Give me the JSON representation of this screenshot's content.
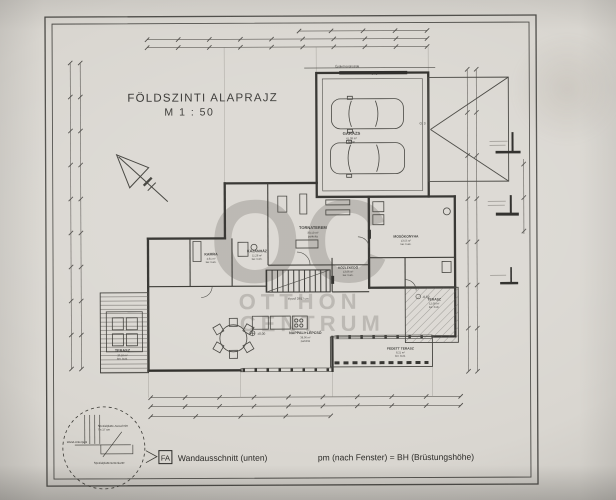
{
  "title": {
    "line1": "FÖLDSZINTI ALAPRAJZ",
    "line2": "M  1 : 50"
  },
  "watermark": {
    "monogram": "OC",
    "line1": "OTTHON",
    "line2": "CENTRUM"
  },
  "rooms": {
    "garazs": {
      "name": "GARÁZS",
      "area": "41,09 m²",
      "finish": "beton"
    },
    "tornaterem": {
      "name": "TORNATEREM",
      "area": "30,10 m²",
      "finish": "parketta"
    },
    "kamra": {
      "name": "KAMRA",
      "area": "4,61 m²",
      "finish": "ker. burk."
    },
    "kazanhaz": {
      "name": "KAZÁNHÁZ",
      "area": "11,28 m²",
      "finish": "ker. burk."
    },
    "mosokonyha": {
      "name": "MOSÓKONYHA",
      "area": "13,55 m²",
      "finish": "ker. burk."
    },
    "kozlekedo": {
      "name": "KÖZLEKEDŐ",
      "area": "13,06 m²",
      "finish": "ker. burk."
    },
    "nappali": {
      "name": "NAPPALI+LÉPCSŐ",
      "area": "38,06 m²",
      "finish": "parketta"
    },
    "terasz_bal": {
      "name": "TERASZ",
      "area": "20,16 m²",
      "finish": "ker. burk."
    },
    "terasz_jobb": {
      "name": "TERASZ",
      "area": "12,06 m²",
      "finish": "ker. burk."
    },
    "fedett_terasz": {
      "name": "FEDETT TERASZ",
      "area": "8,21 m²",
      "finish": "ker. burk."
    }
  },
  "annotations": {
    "walkway": "Épület körüli járda",
    "stair_note": "lépcső 28/17 cm",
    "grid_g1": "G. 1",
    "grid_g3": "G. 3",
    "level_zero": "±0,00",
    "level_minus": "-0,02"
  },
  "detail_inset": {
    "note1": "Spezialplatte-Ausschnitt",
    "note2": "7 x 17 cm",
    "note3": "Wand-Unterputz",
    "note4": "Spezialplattenunterkante"
  },
  "legend": {
    "fa": "FA",
    "wall_cut": "Wandausschnitt (unten)",
    "pm_note": "pm (nach Fenster) = BH (Brüstungshöhe)"
  },
  "colors": {
    "paper": "#d9d6d0",
    "ink": "#2b2a27",
    "watermark": "#6e6a63"
  }
}
